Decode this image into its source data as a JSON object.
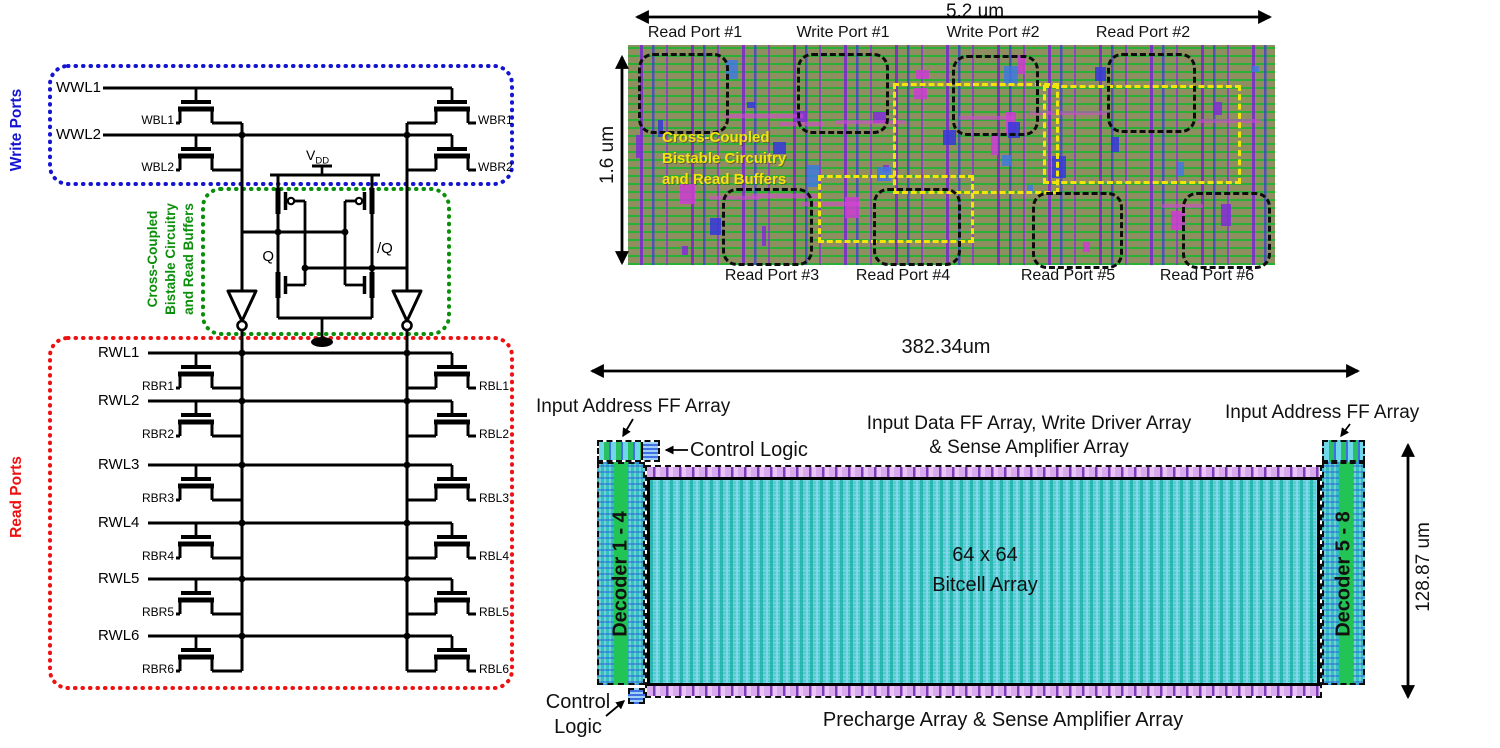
{
  "schematic": {
    "side_labels": {
      "write": "Write Ports",
      "read": "Read Ports"
    },
    "cell_box_label_lines": [
      "Cross-Coupled",
      "Bistable Circuitry",
      "and Read Buffers"
    ],
    "power": {
      "vdd_main": "V",
      "vdd_sub": "DD"
    },
    "nodes": {
      "q": "Q",
      "qbar": "/Q"
    },
    "write_wordlines": [
      "WWL1",
      "WWL2"
    ],
    "write_bitlines_left": [
      "WBL1",
      "WBL2"
    ],
    "write_bitlines_right": [
      "WBR1",
      "WBR2"
    ],
    "read_wordlines": [
      "RWL1",
      "RWL2",
      "RWL3",
      "RWL4",
      "RWL5",
      "RWL6"
    ],
    "read_bitlines_left": [
      "RBR1",
      "RBR2",
      "RBR3",
      "RBR4",
      "RBR5",
      "RBR6"
    ],
    "read_bitlines_right": [
      "RBL1",
      "RBL2",
      "RBL3",
      "RBL4",
      "RBL5",
      "RBL6"
    ],
    "colors": {
      "write_box": "#1414d2",
      "cell_box": "#0a8f0a",
      "read_box": "#ee1111",
      "wire": "#000000"
    }
  },
  "cell_layout": {
    "width_label": "5.2 um",
    "height_label": "1.6 um",
    "top_port_labels": [
      "Read Port #1",
      "Write Port #1",
      "Write Port #2",
      "Read Port #2"
    ],
    "bottom_port_labels": [
      "Read Port #3",
      "Read Port #4",
      "Read Port #5",
      "Read Port #6"
    ],
    "overlay_label_lines": [
      "Cross-Coupled",
      "Bistable Circuitry",
      "and Read Buffers"
    ],
    "colors": {
      "overlay": "#f2e50a",
      "base": "#8e8e60"
    }
  },
  "macro_layout": {
    "width_label": "382.34um",
    "height_label": "128.87 um",
    "array_label_lines": [
      "64 x 64",
      "Bitcell Array"
    ],
    "decoder_left_label": "Decoder 1 - 4",
    "decoder_right_label": "Decoder 5 - 8",
    "input_address_left_label": "Input Address FF Array",
    "input_address_right_label": "Input Address FF Array",
    "input_data_label_lines": [
      "Input Data FF Array, Write Driver Array",
      "& Sense Amplifier Array"
    ],
    "control_logic_top_label": "Control Logic",
    "control_logic_bottom_lines": [
      "Control",
      "Logic"
    ],
    "precharge_label": "Precharge Array & Sense Amplifier Array"
  }
}
